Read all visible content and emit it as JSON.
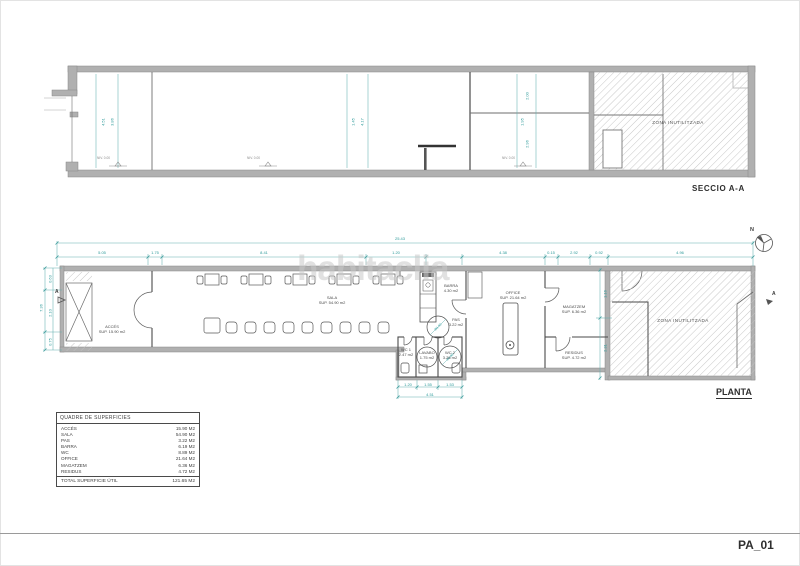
{
  "sheet": {
    "code": "PA_01"
  },
  "watermark": "habitaclia",
  "section": {
    "title": "SECCIO A-A",
    "zone": "ZONA INUTILITZADA",
    "dims_left": [
      "4.51",
      "3.86"
    ],
    "dims_mid": [
      "1.45",
      "4.17"
    ],
    "dims_right": [
      "2.00",
      "1.95",
      "2.96"
    ],
    "levels": [
      "NIV. 0.00",
      "NIV. 0.00",
      "NIV. 0.00"
    ]
  },
  "plan": {
    "title": "PLANTA",
    "north": "N",
    "marker": "A",
    "total_dim": "25.43",
    "dims_top": [
      "5.05",
      "1.75",
      "8.41",
      "1.20",
      "4.38",
      "0.15",
      "2.92",
      "0.92",
      "4.96"
    ],
    "dims_left": {
      "total": "7.36",
      "segs": [
        "0.63",
        "2.10",
        "0.75"
      ]
    },
    "dims_right": [
      "1.16",
      "2.31"
    ],
    "dims_wc": [
      "1.20",
      "1.55",
      "1.53"
    ],
    "dims_wc_total": "4.51",
    "circle_dim": "Ø1.50",
    "zone": "ZONA INUTILITZADA",
    "rooms": {
      "acces": {
        "name": "ACCÉS",
        "area": "SUP. 15.90 m2"
      },
      "sala": {
        "name": "SALA",
        "area": "SUP. 54.90 m2"
      },
      "barra": {
        "name": "BARRA",
        "area": "4.30 m2"
      },
      "pas": {
        "name": "PAS",
        "area": "3.22 m2"
      },
      "office": {
        "name": "OFFICE",
        "area": "SUP. 21.64 m2"
      },
      "magatzem": {
        "name": "MAGATZEM",
        "area": "SUP. 6.36 m2"
      },
      "residus": {
        "name": "RESIDUS",
        "area": "SUP. 4.72 m2"
      },
      "wc1": {
        "name": "WC 1",
        "area": "2.47 m2"
      },
      "lavabo": {
        "name": "LAVABO",
        "area": "1.75 m2"
      },
      "wc2": {
        "name": "WC 2",
        "area": "3.26 m2"
      }
    }
  },
  "surfaces": {
    "title": "QUADRE DE SUPERFICIES",
    "rows": [
      {
        "label": "ACCÉS",
        "value": "15.90 M2"
      },
      {
        "label": "SALA",
        "value": "54.90 M2"
      },
      {
        "label": "PAS",
        "value": "3.22 M2"
      },
      {
        "label": "BARRA",
        "value": "6.19 M2"
      },
      {
        "label": "WC",
        "value": "8.89 M2"
      },
      {
        "label": "OFFICE",
        "value": "21.64 M2"
      },
      {
        "label": "MAGATZEM",
        "value": "6.36 M2"
      },
      {
        "label": "RESIDUS",
        "value": "4.72 M2"
      }
    ],
    "total": {
      "label": "TOTAL SUPERFICIE ÚTIL",
      "value": "121.65 M2"
    }
  },
  "colors": {
    "dimension": "#2f9b9b",
    "wall": "#b0b0b0",
    "line": "#4a4a4a",
    "watermark": "#c9c9c9"
  }
}
